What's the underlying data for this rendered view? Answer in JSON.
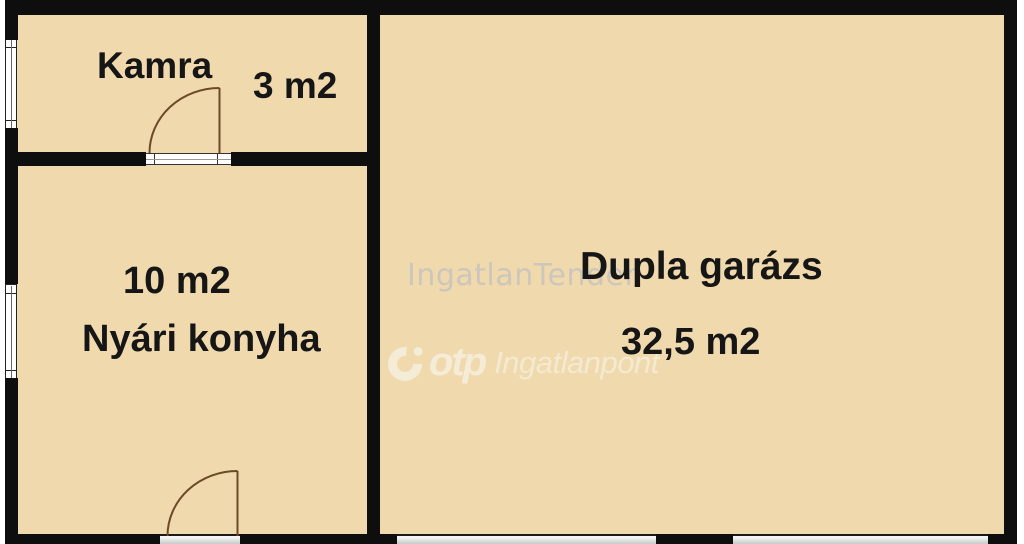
{
  "plan": {
    "rooms": [
      {
        "name": "Kamra",
        "area": "3 m2"
      },
      {
        "name": "Nyári konyha",
        "area": "10 m2"
      },
      {
        "name": "Dupla garázs",
        "area": "32,5 m2"
      }
    ],
    "watermarks": {
      "site": "IngatlanTender",
      "brand": "otp",
      "brand_suffix": "Ingatlanpont"
    },
    "symbols": {
      "door": "door-swing-icon",
      "window": "window-icon",
      "garage_opening": "garage-door-opening"
    },
    "colors": {
      "floor": "#f0d9ad",
      "wall": "#0e0e0e",
      "door": "#6b4a26",
      "watermark_gray": "#b7bbc4",
      "watermark_cream": "#f5ecd8"
    }
  }
}
